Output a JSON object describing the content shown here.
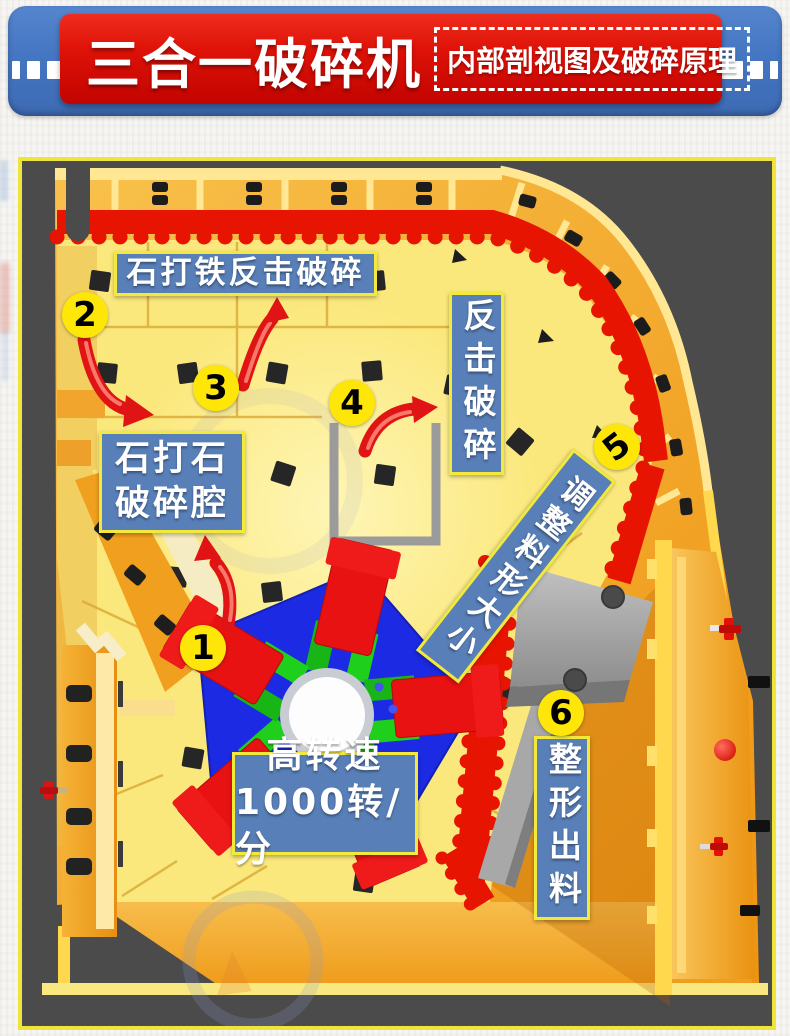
{
  "header": {
    "title": "三合一破碎机",
    "subtitle": "内部剖视图及破碎原理"
  },
  "diagram": {
    "markers": [
      "1",
      "2",
      "3",
      "4",
      "5",
      "6"
    ],
    "labels": {
      "impact_iron": "石打铁反击破碎",
      "impact_crush": "反击破碎",
      "stone_on_stone_line1": "石打石",
      "stone_on_stone_line2": "破碎腔",
      "adjust_size": "调整料形大小",
      "speed_line1": "高转速",
      "speed_line2": "1000转/分",
      "shaping_discharge": "整形出料"
    },
    "colors": {
      "panel_background": "#4b4b4b",
      "panel_border": "#efe43a",
      "machine_yellow": "#fbe87c",
      "casing_orange": "#f3a41f",
      "liner_red": "#e61400",
      "rotor_blue": "#1c2ae4",
      "hammer_red": "#e81212",
      "hammer_green": "#1ec41c",
      "label_background": "#587fb8",
      "label_border": "#f2e93c",
      "marker_yellow": "#ffe609",
      "header_blue": "#4576c2",
      "header_red": "#d60d0d"
    }
  }
}
